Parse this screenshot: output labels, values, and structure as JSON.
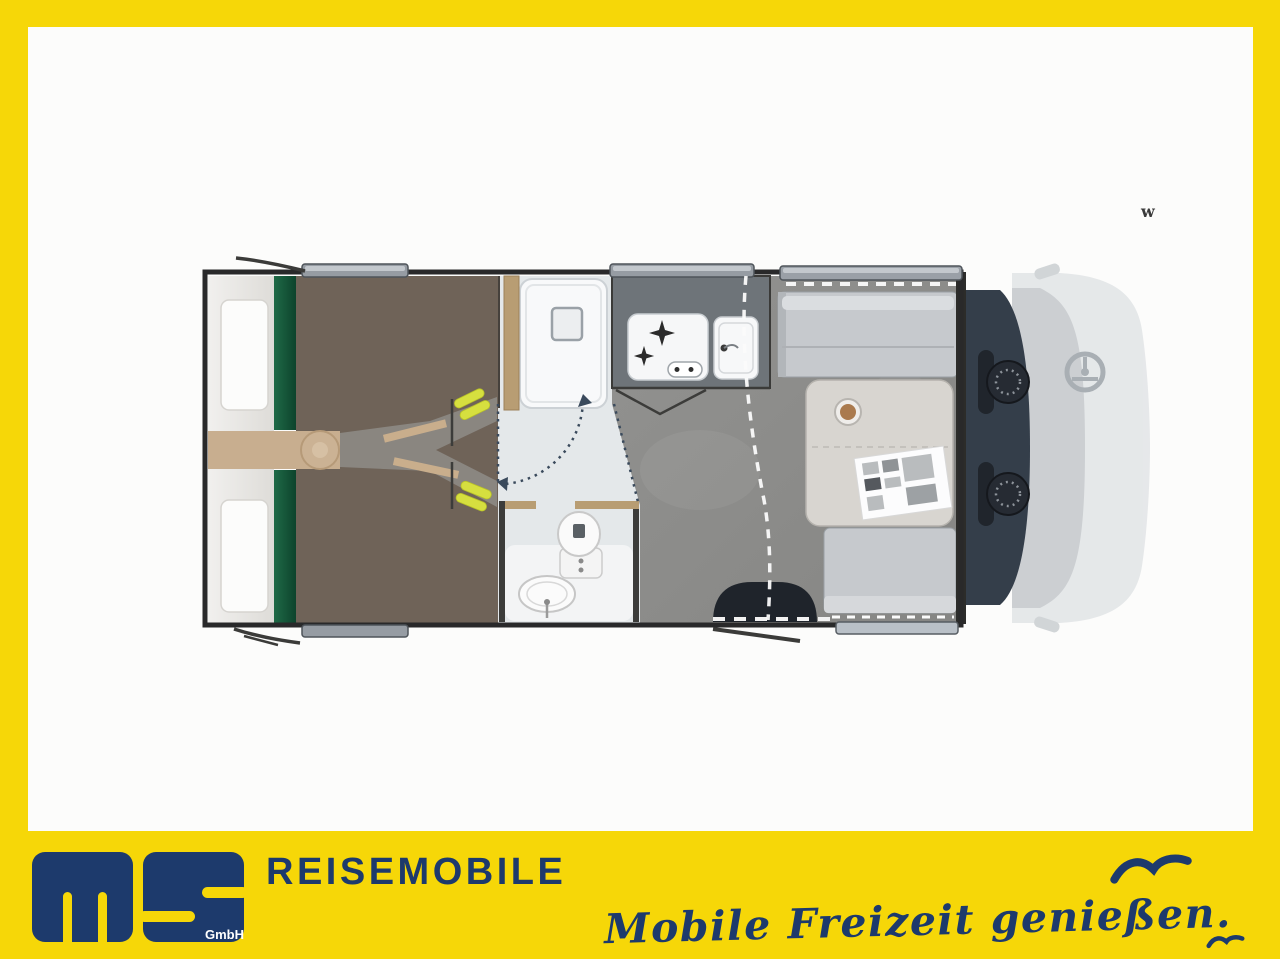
{
  "watermark": {
    "text": "w"
  },
  "brand": {
    "logo_letters": "ms",
    "logo_sub": "GmbH",
    "wordmark": "REISEMOBILE",
    "tagline": "Mobile Freizeit genießen."
  },
  "colors": {
    "frame_yellow": "#F6D708",
    "brand_navy": "#1D3A6C",
    "bed_platform_brown": "#6F6358",
    "floor_gray": "#8D8D8B",
    "bathroom_gray": "#E4E8EA",
    "kitchen_counter": "#6E7479",
    "cab_dark": "#343E4A",
    "wood_tan": "#B89D73",
    "accent_lime": "#D6DF3F"
  },
  "floorplan": {
    "features": [
      "rear-bed",
      "bed-pillows",
      "bike-garage",
      "shower-cabin",
      "toilet",
      "washbasin",
      "kitchen-stove",
      "kitchen-sink",
      "dinette-bench",
      "dinette-table",
      "entry-step",
      "cab-swivel-seats",
      "steering-wheel",
      "windows",
      "door-swing-arc",
      "curtain-track"
    ]
  }
}
